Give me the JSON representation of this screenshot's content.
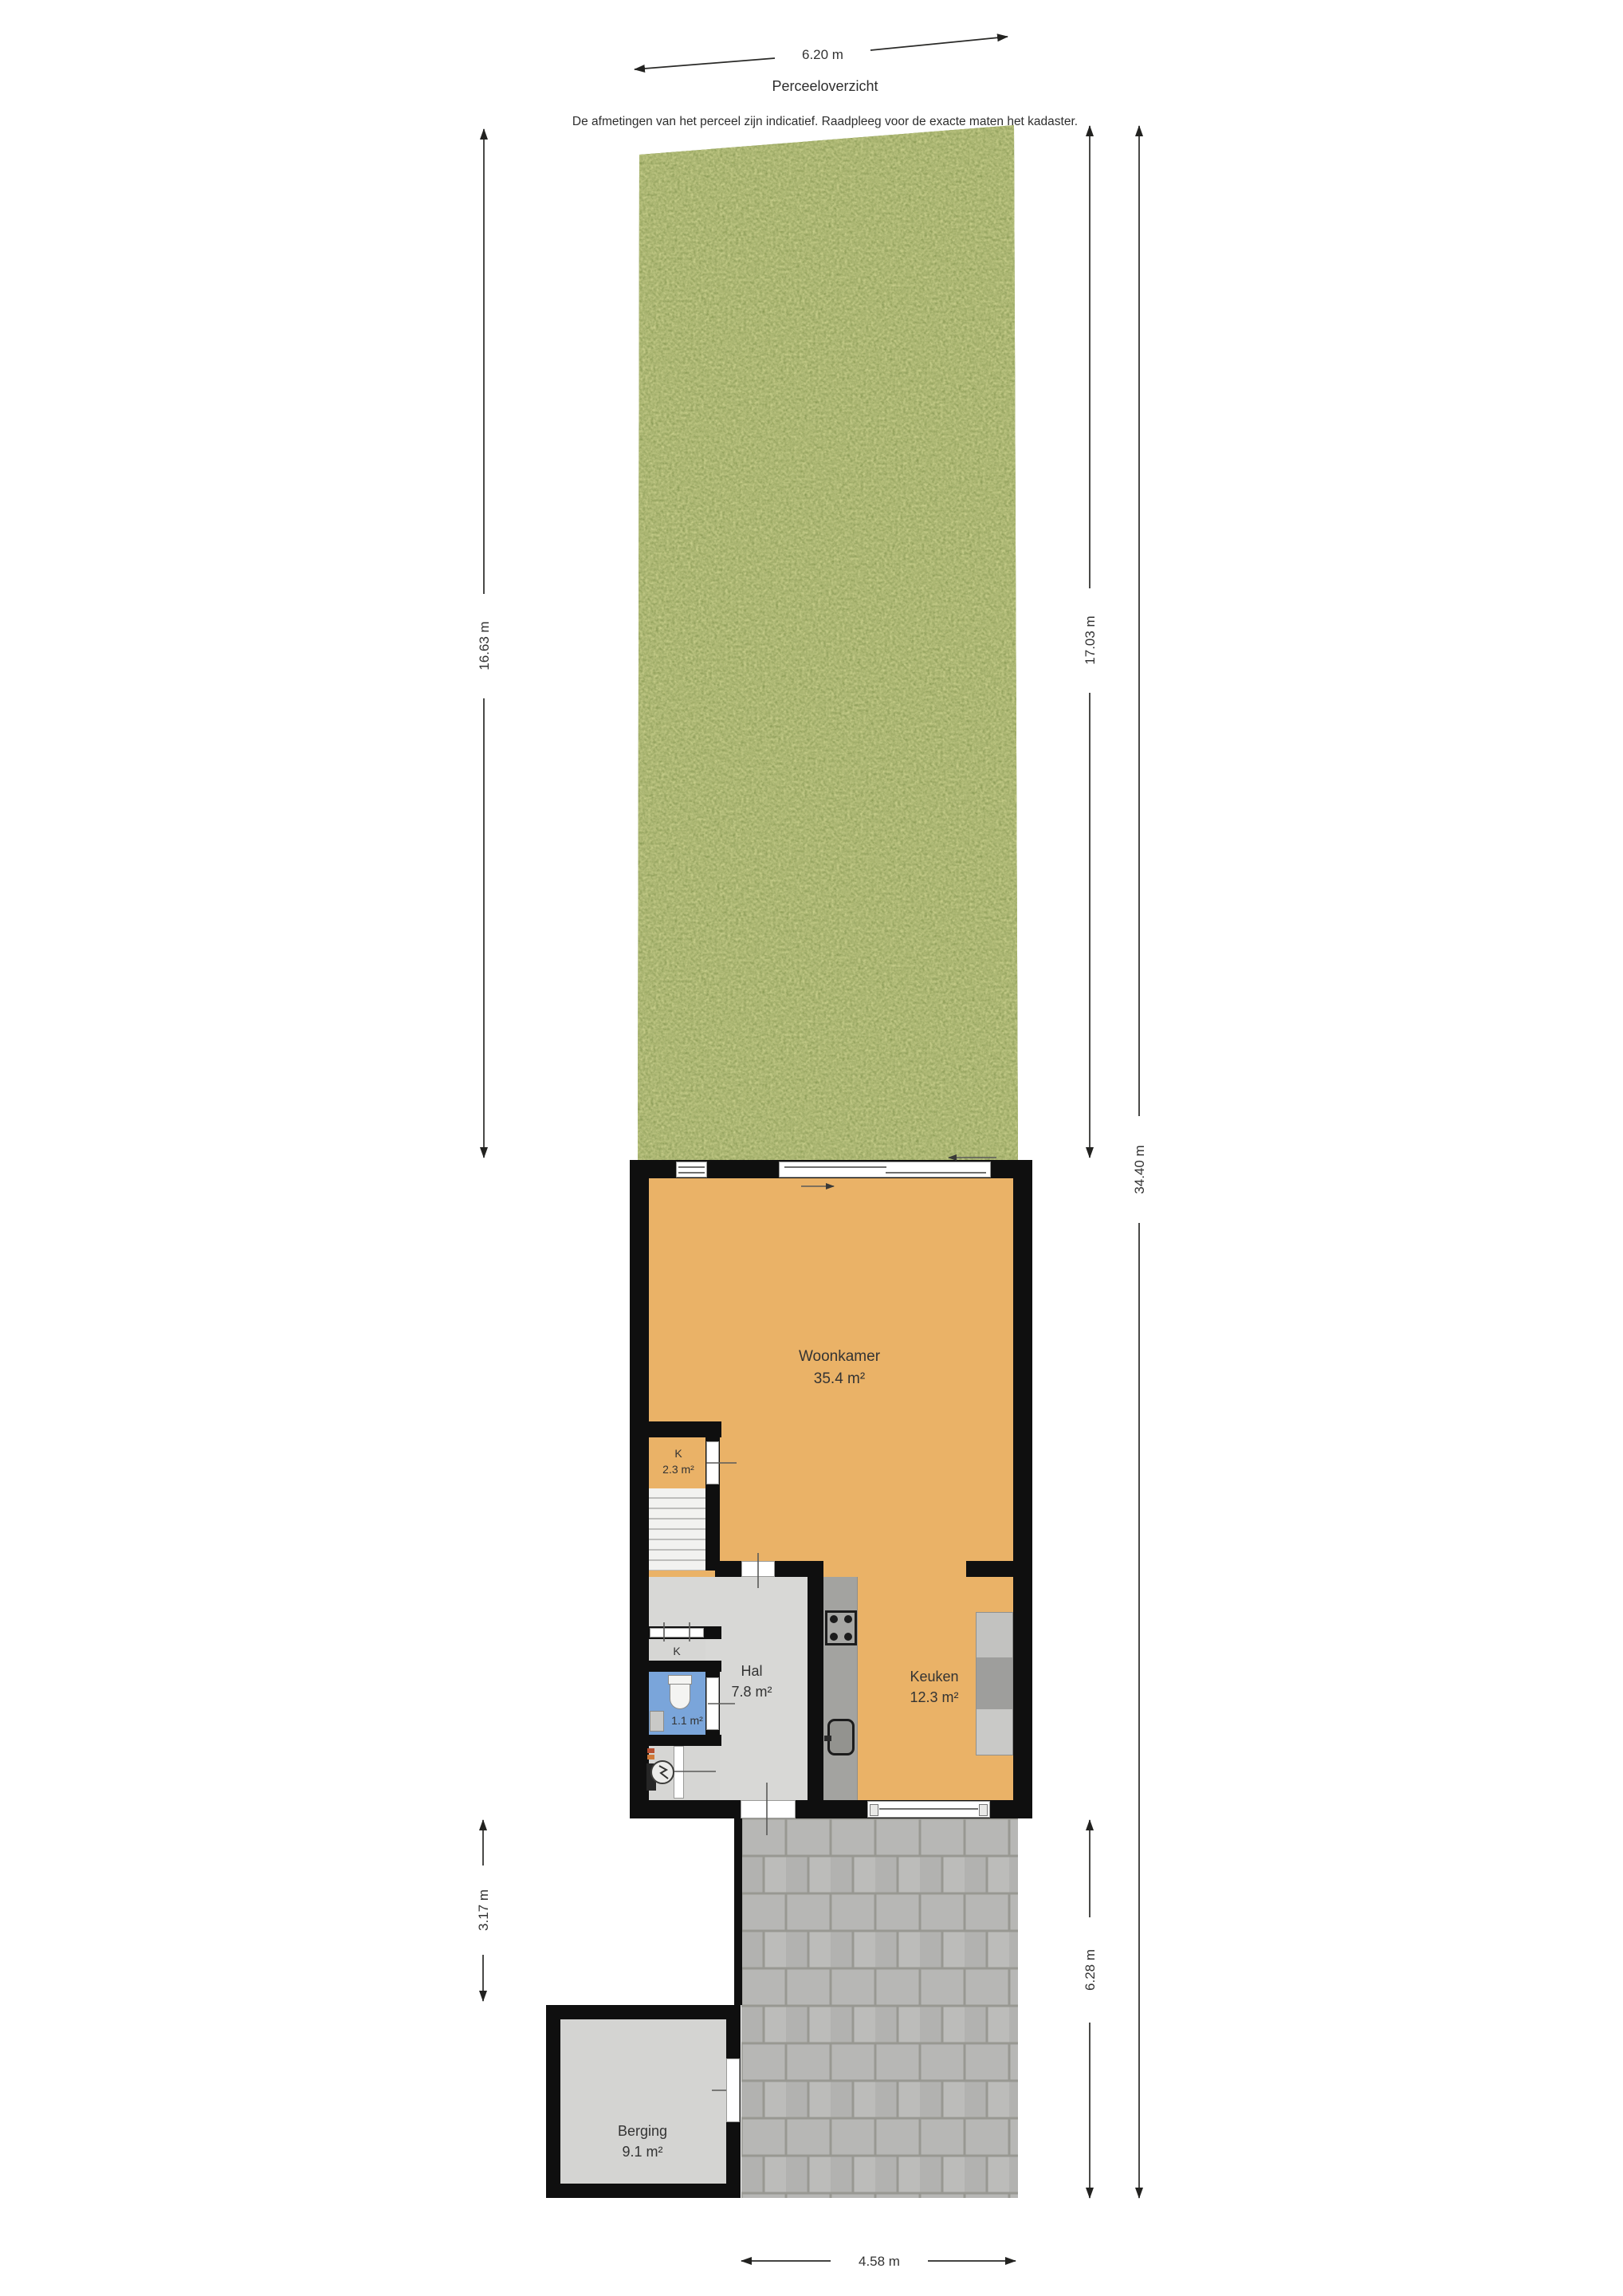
{
  "meta": {
    "title": "Perceeloverzicht",
    "subtitle": "De afmetingen van het perceel zijn indicatief. Raadpleeg voor de exacte maten het kadaster."
  },
  "dimensions": {
    "top_width": "6.20 m",
    "garden_left_depth": "16.63 m",
    "garden_right_depth": "17.03 m",
    "parcel_total_depth": "34.40 m",
    "side_passage_depth": "3.17 m",
    "terrace_depth": "6.28 m",
    "terrace_width": "4.58 m"
  },
  "rooms": {
    "woonkamer": {
      "name": "Woonkamer",
      "area": "35.4 m²"
    },
    "closet_upper": {
      "name": "K",
      "area": "2.3 m²"
    },
    "hal": {
      "name": "Hal",
      "area": "7.8 m²"
    },
    "keuken": {
      "name": "Keuken",
      "area": "12.3 m²"
    },
    "toilet": {
      "area": "1.1 m²"
    },
    "closet_lower": {
      "name": "K"
    },
    "berging": {
      "name": "Berging",
      "area": "9.1 m²"
    }
  },
  "colors": {
    "wall": "#0f0f0f",
    "floor-warm": "#eab267",
    "floor-gray": "#d8d8d6",
    "floor-blue": "#7aa5da",
    "grass": "#7a8e3e",
    "paving": "#b5b5b3",
    "paving-joint": "#95958f",
    "counter": "#a3a3a0",
    "berging-floor": "#d4d4d2",
    "dim-line": "#2a2a2a",
    "text": "#333333"
  }
}
